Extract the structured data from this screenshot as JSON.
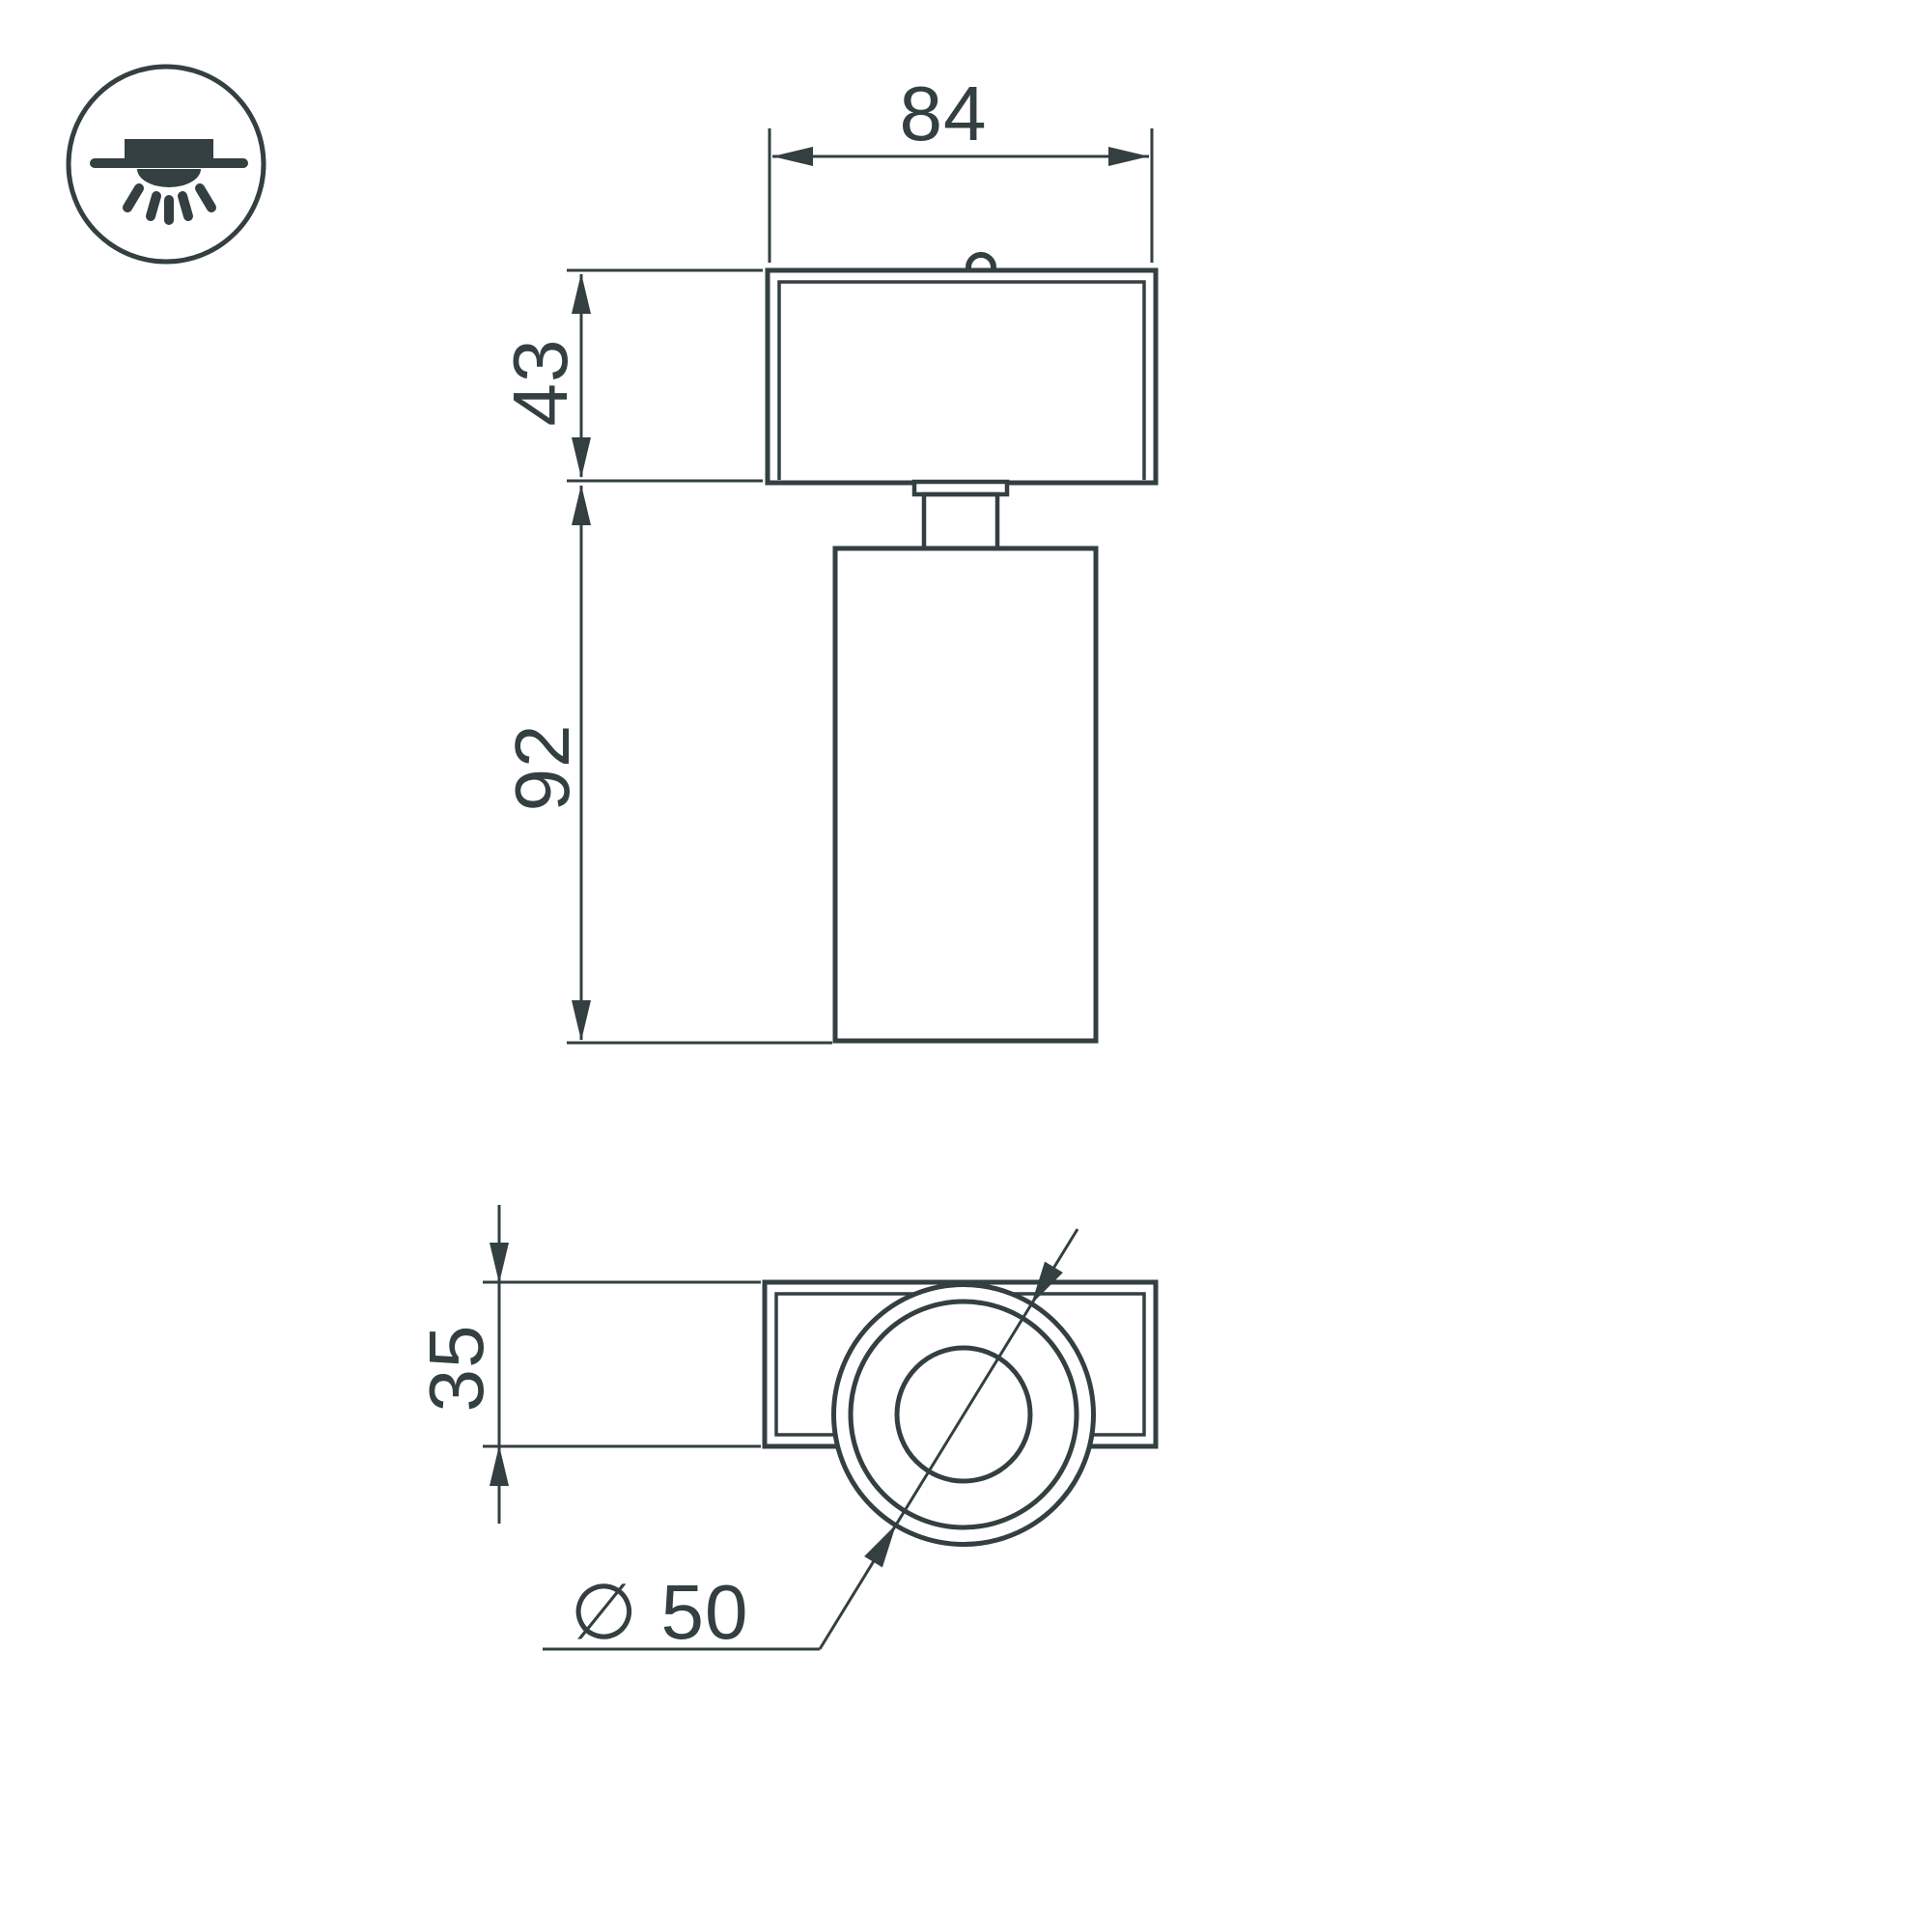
{
  "drawing": {
    "background_color": "#ffffff",
    "line_color": "#333f40",
    "labels": {
      "width": "84",
      "head_height": "43",
      "body_height": "92",
      "base_depth": "35",
      "diameter": "∅ 50"
    },
    "icon": "surface-mounted-ceiling-light"
  }
}
